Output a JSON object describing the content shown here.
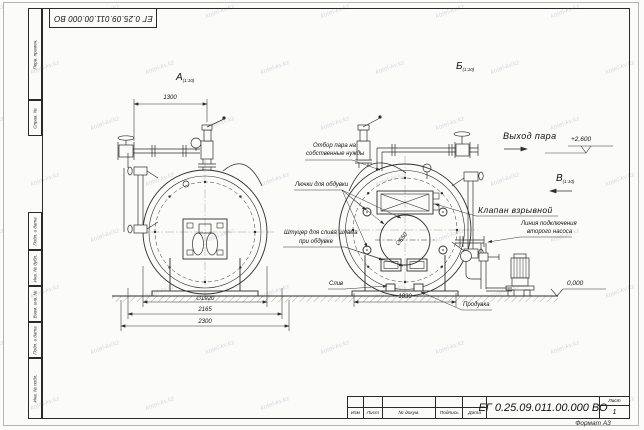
{
  "document": {
    "number": "ЕГ 0.25.09.011.00.000 ВО",
    "format_note": "Формат А3",
    "sheet_label": "Лист",
    "sheet_number": "1"
  },
  "title_block": {
    "cols": [
      "Изм",
      "Лист",
      "№ докум.",
      "Подпись",
      "Дата"
    ]
  },
  "frame_side_labels": [
    "Перв. примен.",
    "Справ. №",
    "Подп. и дата",
    "Инв. № дубл.",
    "Взам. инв. №",
    "Подп. и дата",
    "Инв. № подл."
  ],
  "watermark": {
    "text": "kotel-kv.kz"
  },
  "views": {
    "a": {
      "label": "А",
      "sub": "(1:10)"
    },
    "b": {
      "label": "Б",
      "sub": "(1:10)"
    },
    "v": {
      "label": "В",
      "sub": "(1:10)"
    }
  },
  "labels": {
    "steam_outlet": "Выход пара",
    "elevation_top": "+2,600",
    "elevation_zero": "0,000",
    "explosion_valve": "Клапан взрывной",
    "own_needs_line1": "Отбор пара на",
    "own_needs_line2": "собственные нужды",
    "blow_hatches": "Лючки для обдувки",
    "sludge_line1": "Штуцер для слива шлама",
    "sludge_line2": "при обдувке",
    "drain": "Слив",
    "blowdown": "Продувка",
    "pump_line1": "Линия подключения",
    "pump_line2": "второго насоса"
  },
  "dimensions": {
    "top_width": "1300",
    "shell_diameter": "∅1920",
    "width_mid": "2165",
    "width_total": "2300",
    "right_base": "1830",
    "manhole_diameter": "∅650"
  }
}
